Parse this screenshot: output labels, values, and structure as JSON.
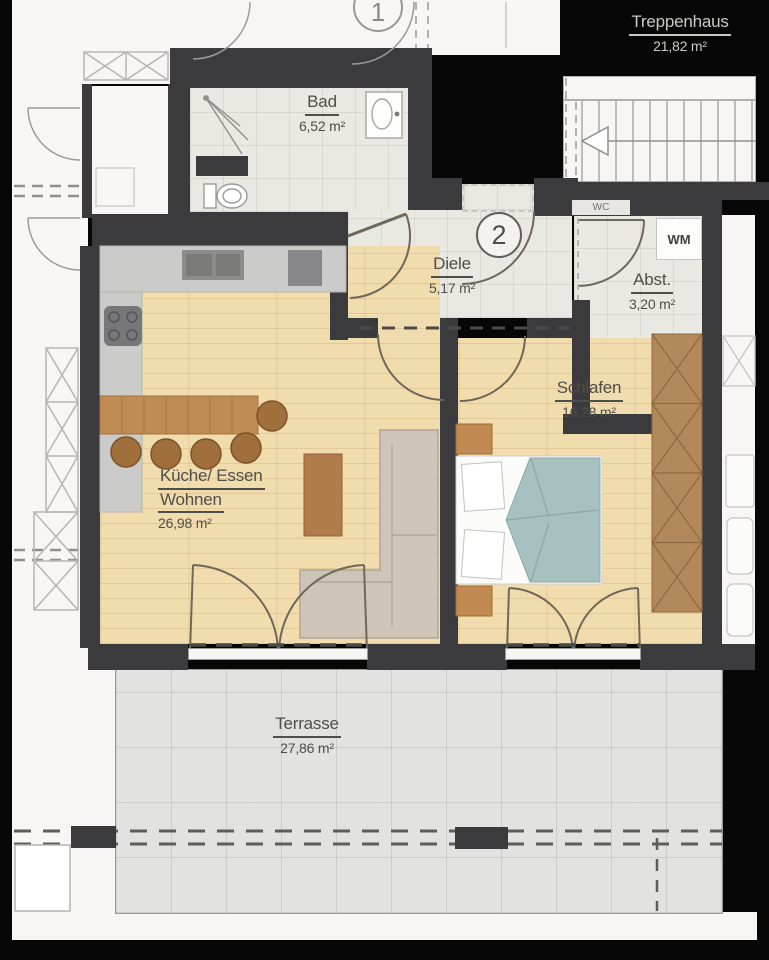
{
  "plan": {
    "badges": {
      "unit": "2",
      "neighbor_unit": "1"
    },
    "rooms": [
      {
        "id": "treppenhaus",
        "name": "Treppenhaus",
        "area": "21,82 m²"
      },
      {
        "id": "bad",
        "name": "Bad",
        "area": "6,52 m²"
      },
      {
        "id": "diele",
        "name": "Diele",
        "area": "5,17 m²"
      },
      {
        "id": "abstellraum",
        "name": "Abst.",
        "area": "3,20 m²"
      },
      {
        "id": "schlafen",
        "name": "Schlafen",
        "area": "16,28 m²"
      },
      {
        "id": "kueche-essen-wohnen",
        "name": "Küche/ Essen",
        "name2": "Wohnen",
        "area": "26,98 m²"
      },
      {
        "id": "terrasse",
        "name": "Terrasse",
        "area": "27,86 m²"
      }
    ],
    "labels": {
      "wm": "WM",
      "wc": "WC"
    },
    "colors": {
      "wall": "#3b3b3d",
      "wood_floor": "#f1dcae",
      "tile_floor": "#eae8e3",
      "terrace": "#e2e2e0",
      "bed_blanket": "#a6c1bf",
      "wardrobe": "#b3885a",
      "background": "#070707"
    }
  }
}
